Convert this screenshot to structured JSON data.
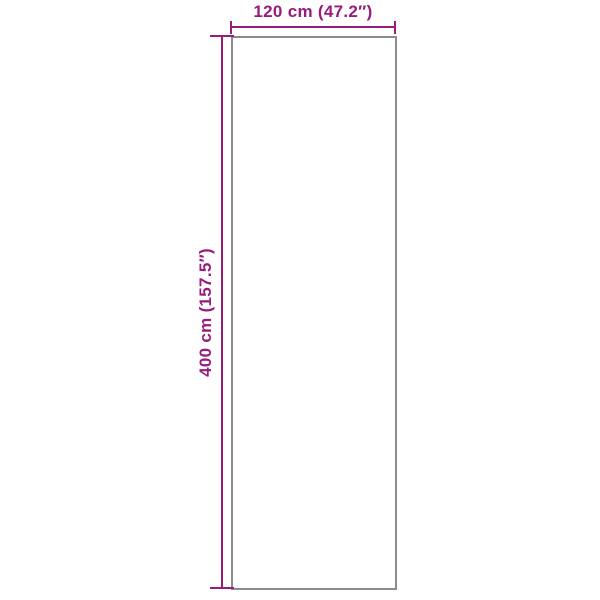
{
  "dimensions": {
    "width_label": "120 cm (47.2″)",
    "height_label": "400 cm (157.5″)",
    "width_cm": 120,
    "width_in": 47.2,
    "height_cm": 400,
    "height_in": 157.5
  },
  "colors": {
    "accent": "#981B7E",
    "outline": "#8C8C8C",
    "background": "#FFFFFF"
  }
}
